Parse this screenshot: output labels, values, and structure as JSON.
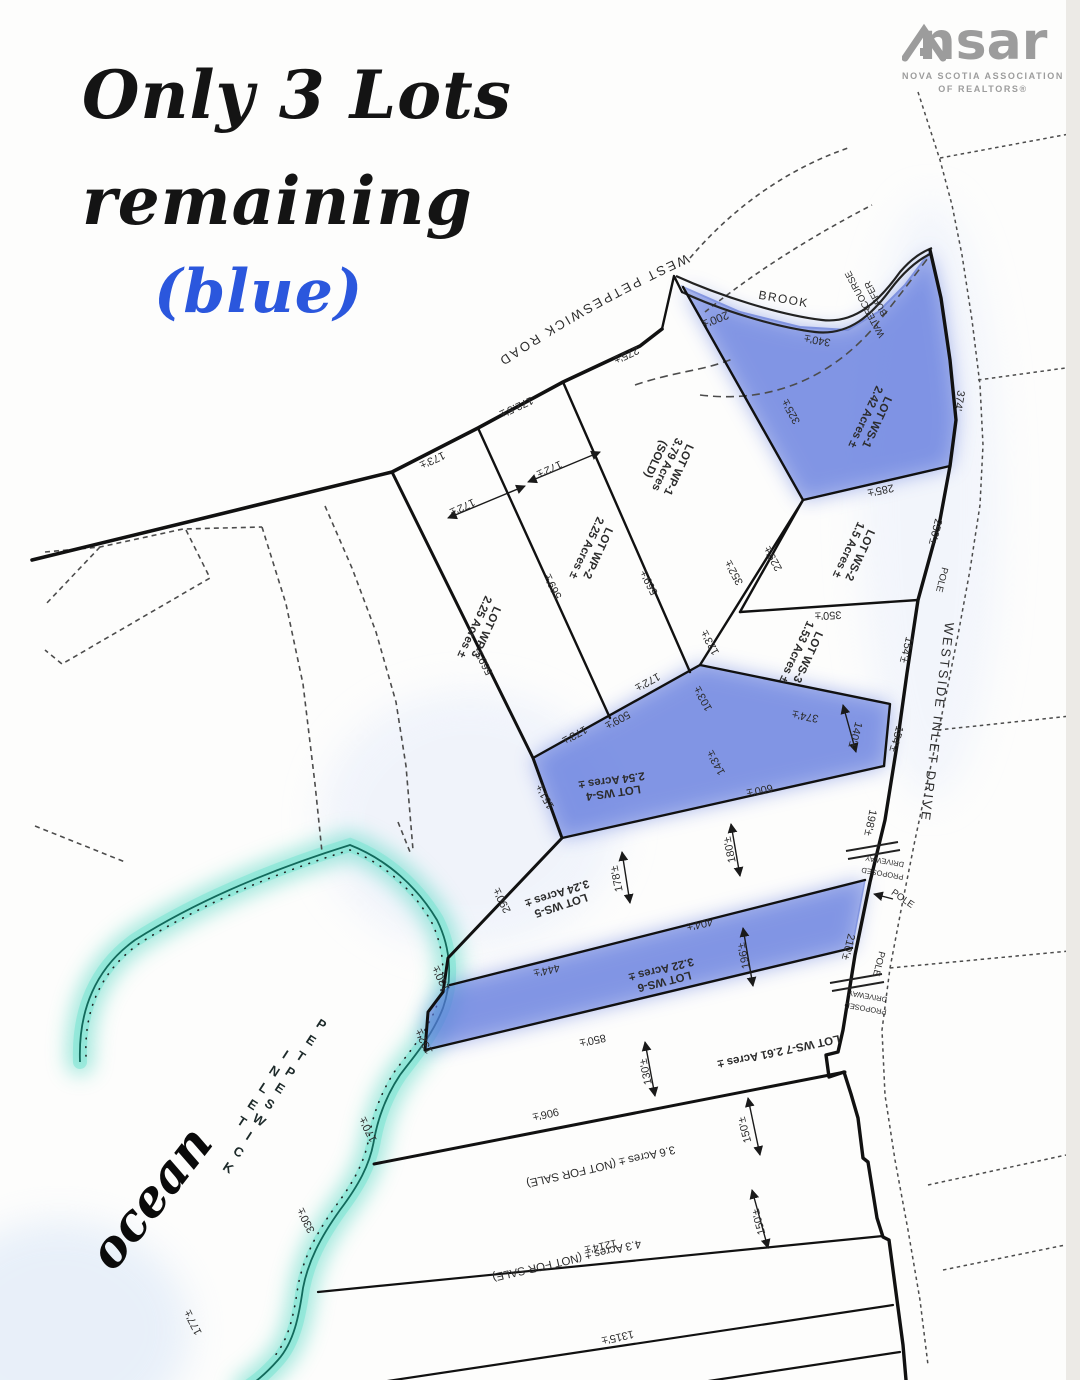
{
  "page": {
    "title_line1": "Only 3 Lots",
    "title_line2": "remaining",
    "title_line3": "(blue)"
  },
  "logo": {
    "ns": "ns",
    "ar": "ar",
    "caption1": "NOVA SCOTIA ASSOCIATION",
    "caption2": "OF REALTORS®"
  },
  "colors": {
    "heading_text": "#141414",
    "heading_blue": "#2b57dd",
    "logo_gray": "#9c9c9c",
    "lot_highlight_blue": "#5a74dd",
    "shore_teal": "#5fd9c6",
    "line_black": "#1a1a1a"
  },
  "map": {
    "road_top_label": "WEST PETPESWICK ROAD",
    "water_labels": {
      "ocean": "ocean",
      "inlet_word1": "PETPESWICK",
      "inlet_word2": "INLET"
    },
    "labels": [
      {
        "id": "westside-inlet-drive",
        "text": "WESTSIDE INLET DRIVE",
        "x": 933,
        "y": 722,
        "rot": 97,
        "size": 13,
        "ls": 2.5
      },
      {
        "id": "brook",
        "text": "BROOK",
        "x": 783,
        "y": 303,
        "rot": 10,
        "size": 12,
        "ls": 1.5
      },
      {
        "id": "dim-200",
        "text": "200'±",
        "x": 714,
        "y": 316,
        "rot": 158,
        "size": 11.5
      },
      {
        "id": "dim-340",
        "text": "340'±",
        "x": 818,
        "y": 337,
        "rot": 190,
        "size": 11
      },
      {
        "id": "watercourse-buffer",
        "lines": [
          "WATERCOURSE",
          "BUFFER"
        ],
        "x": 873,
        "y": 300,
        "rot": 242,
        "size": 9.5
      },
      {
        "id": "lot-ws1",
        "lines": [
          "LOT WS-1",
          "2.42 Acres ±"
        ],
        "x": 868,
        "y": 418,
        "rot": 115,
        "size": 11.5,
        "b": 1
      },
      {
        "id": "dim-325",
        "text": "325'±",
        "x": 794,
        "y": 410,
        "rot": 241,
        "size": 11
      },
      {
        "id": "dim-374-road",
        "text": "374'",
        "x": 956,
        "y": 400,
        "rot": 100,
        "size": 11
      },
      {
        "id": "dim-285",
        "text": "285'±",
        "x": 880,
        "y": 487,
        "rot": 168,
        "size": 11
      },
      {
        "id": "dim-250",
        "text": "250'±",
        "x": 932,
        "y": 531,
        "rot": 104,
        "size": 11
      },
      {
        "id": "pole-1",
        "text": "POLE",
        "x": 939,
        "y": 579,
        "rot": 104,
        "size": 9.5
      },
      {
        "id": "lot-ws2",
        "lines": [
          "LOT WS-2",
          "1.5 Acres ±"
        ],
        "x": 851,
        "y": 551,
        "rot": 115,
        "size": 11.5,
        "b": 1
      },
      {
        "id": "dim-229",
        "text": "229'±",
        "x": 776,
        "y": 557,
        "rot": 241,
        "size": 11
      },
      {
        "id": "dim-352",
        "text": "352'±",
        "x": 737,
        "y": 571,
        "rot": 241,
        "size": 11
      },
      {
        "id": "dim-350",
        "text": "350'±",
        "x": 828,
        "y": 612,
        "rot": 177,
        "size": 11
      },
      {
        "id": "dim-123",
        "text": "123'±",
        "x": 713,
        "y": 641,
        "rot": 241,
        "size": 11
      },
      {
        "id": "dim-103",
        "text": "103'±",
        "x": 706,
        "y": 697,
        "rot": 241,
        "size": 11
      },
      {
        "id": "lot-ws3",
        "lines": [
          "LOT WS-3",
          "1.53 Acres ±"
        ],
        "x": 799,
        "y": 653,
        "rot": 115,
        "size": 11.5,
        "b": 1
      },
      {
        "id": "dim-154-a",
        "text": "154'±",
        "x": 903,
        "y": 649,
        "rot": 104,
        "size": 11
      },
      {
        "id": "dim-374-b",
        "text": "374'±",
        "x": 806,
        "y": 713,
        "rot": 191,
        "size": 11
      },
      {
        "id": "dim-140",
        "text": "140'±",
        "x": 852,
        "y": 734,
        "rot": 106,
        "size": 11
      },
      {
        "id": "dim-154-b",
        "text": "154'±",
        "x": 893,
        "y": 738,
        "rot": 106,
        "size": 11
      },
      {
        "id": "dim-143",
        "text": "143'±",
        "x": 719,
        "y": 761,
        "rot": 241,
        "size": 11
      },
      {
        "id": "lot-ws4",
        "lines": [
          "LOT WS-4",
          "2.54 Acres ±"
        ],
        "x": 612,
        "y": 783,
        "rot": 172,
        "size": 11.5,
        "b": 1
      },
      {
        "id": "dim-600",
        "text": "600'±",
        "x": 759,
        "y": 787,
        "rot": 168,
        "size": 11
      },
      {
        "id": "dim-151",
        "text": "151'±",
        "x": 548,
        "y": 795,
        "rot": 241,
        "size": 11
      },
      {
        "id": "dim-173-a",
        "text": "173'±",
        "x": 573,
        "y": 732,
        "rot": 151,
        "size": 11
      },
      {
        "id": "dim-509",
        "text": "509'±",
        "x": 616,
        "y": 717,
        "rot": 151,
        "size": 11
      },
      {
        "id": "dim-172-c",
        "text": "172'±",
        "x": 646,
        "y": 679,
        "rot": 151,
        "size": 11
      },
      {
        "id": "dim-569-a",
        "text": "569'±",
        "x": 487,
        "y": 661,
        "rot": 243,
        "size": 11
      },
      {
        "id": "dim-569-b",
        "text": "569'±",
        "x": 556,
        "y": 585,
        "rot": 243,
        "size": 11
      },
      {
        "id": "dim-569-c",
        "text": "569'±",
        "x": 652,
        "y": 581,
        "rot": 243,
        "size": 11
      },
      {
        "id": "lot-wp3",
        "lines": [
          "LOT WP-3",
          "2.25 Acres ±"
        ],
        "x": 477,
        "y": 628,
        "rot": 115,
        "size": 11.5,
        "b": 1
      },
      {
        "id": "lot-wp2",
        "lines": [
          "LOT WP-2",
          "2.25 Acres ±"
        ],
        "x": 589,
        "y": 549,
        "rot": 115,
        "size": 11.5,
        "b": 1
      },
      {
        "id": "lot-wp1",
        "lines": [
          "LOT WP-1",
          "3.79 Acres",
          "(SOLD)"
        ],
        "x": 664,
        "y": 463,
        "rot": 115,
        "size": 11.5,
        "b": 1
      },
      {
        "id": "dim-173-b",
        "text": "173'±",
        "x": 431,
        "y": 457,
        "rot": 155,
        "size": 11
      },
      {
        "id": "dim-172p5",
        "text": "172.5'±",
        "x": 515,
        "y": 404,
        "rot": 155,
        "size": 11
      },
      {
        "id": "dim-275",
        "text": "275'±",
        "x": 625,
        "y": 352,
        "rot": 155,
        "size": 11
      },
      {
        "id": "dim-172-a",
        "text": "172'±",
        "x": 461,
        "y": 504,
        "rot": 155,
        "size": 11
      },
      {
        "id": "dim-172-b",
        "text": "172'±",
        "x": 548,
        "y": 466,
        "rot": 155,
        "size": 11
      },
      {
        "id": "lot-ws5",
        "lines": [
          "LOT WS-5",
          "3.24 Acres ±"
        ],
        "x": 558,
        "y": 896,
        "rot": 162,
        "size": 11.5,
        "b": 1
      },
      {
        "id": "dim-290",
        "text": "290'±",
        "x": 505,
        "y": 899,
        "rot": 243,
        "size": 11
      },
      {
        "id": "dim-178",
        "text": "178'±",
        "x": 620,
        "y": 878,
        "rot": 258,
        "size": 11
      },
      {
        "id": "dim-180",
        "text": "180'±",
        "x": 733,
        "y": 849,
        "rot": 258,
        "size": 11
      },
      {
        "id": "dim-198",
        "text": "198'±",
        "x": 867,
        "y": 822,
        "rot": 102,
        "size": 11
      },
      {
        "id": "proposed-driveway-1",
        "lines": [
          "PROPOSED",
          "DRIVEWAY"
        ],
        "x": 884,
        "y": 865,
        "rot": 190,
        "size": 7.5
      },
      {
        "id": "pole-2",
        "text": "POLE",
        "x": 901,
        "y": 901,
        "rot": 35,
        "size": 9.5
      },
      {
        "id": "dim-404",
        "text": "404'±",
        "x": 699,
        "y": 921,
        "rot": 167,
        "size": 11
      },
      {
        "id": "dim-444",
        "text": "444'±",
        "x": 546,
        "y": 967,
        "rot": 167,
        "size": 11
      },
      {
        "id": "lot-ws6",
        "lines": [
          "LOT WS-6",
          "3.22 Acres ±"
        ],
        "x": 662,
        "y": 972,
        "rot": 166,
        "size": 11.5,
        "b": 1
      },
      {
        "id": "dim-196",
        "text": "196'±",
        "x": 747,
        "y": 955,
        "rot": 258,
        "size": 11
      },
      {
        "id": "dim-210",
        "text": "210'±",
        "x": 845,
        "y": 946,
        "rot": 104,
        "size": 11
      },
      {
        "id": "pole-3",
        "text": "POLE",
        "x": 876,
        "y": 963,
        "rot": 104,
        "size": 9.5
      },
      {
        "id": "proposed-driveway-2",
        "lines": [
          "PROPOSED",
          "DRIVEWAY"
        ],
        "x": 867,
        "y": 1000,
        "rot": 190,
        "size": 7.5
      },
      {
        "id": "dim-130-shore",
        "text": "130'±",
        "x": 444,
        "y": 977,
        "rot": 243,
        "size": 11
      },
      {
        "id": "dim-132",
        "text": "132'±",
        "x": 427,
        "y": 1040,
        "rot": 243,
        "size": 11
      },
      {
        "id": "dim-850",
        "text": "850'±",
        "x": 592,
        "y": 1037,
        "rot": 168,
        "size": 11
      },
      {
        "id": "lot-ws7",
        "text": "LOT WS-7  2.61 Acres ±",
        "x": 778,
        "y": 1048,
        "rot": 168,
        "size": 11.5,
        "b": 1
      },
      {
        "id": "dim-130-b",
        "text": "130'±",
        "x": 649,
        "y": 1071,
        "rot": 258,
        "size": 11
      },
      {
        "id": "dim-906",
        "text": "906'±",
        "x": 545,
        "y": 1111,
        "rot": 167,
        "size": 11
      },
      {
        "id": "not-for-sale-1",
        "text": "3.6 Acres ±  (NOT FOR SALE)",
        "x": 600,
        "y": 1163,
        "rot": 167,
        "size": 11.5
      },
      {
        "id": "dim-150-a",
        "text": "150'±",
        "x": 748,
        "y": 1129,
        "rot": 255,
        "size": 11
      },
      {
        "id": "dim-1214",
        "text": "1214'±",
        "x": 600,
        "y": 1243,
        "rot": 167,
        "size": 11
      },
      {
        "id": "not-for-sale-2",
        "text": "4.3 Acres ±  (NOT FOR SALE)",
        "x": 566,
        "y": 1257,
        "rot": 167,
        "size": 11.5
      },
      {
        "id": "dim-150-b",
        "text": "150'±",
        "x": 762,
        "y": 1221,
        "rot": 255,
        "size": 11
      },
      {
        "id": "dim-1315",
        "text": "1315'±",
        "x": 617,
        "y": 1334,
        "rot": 167,
        "size": 11
      },
      {
        "id": "dim-170",
        "text": "170'±",
        "x": 371,
        "y": 1128,
        "rot": 243,
        "size": 11
      },
      {
        "id": "dim-330",
        "text": "330'±",
        "x": 309,
        "y": 1219,
        "rot": 243,
        "size": 11
      },
      {
        "id": "dim-177",
        "text": "177'±",
        "x": 196,
        "y": 1321,
        "rot": 243,
        "size": 11
      }
    ]
  }
}
